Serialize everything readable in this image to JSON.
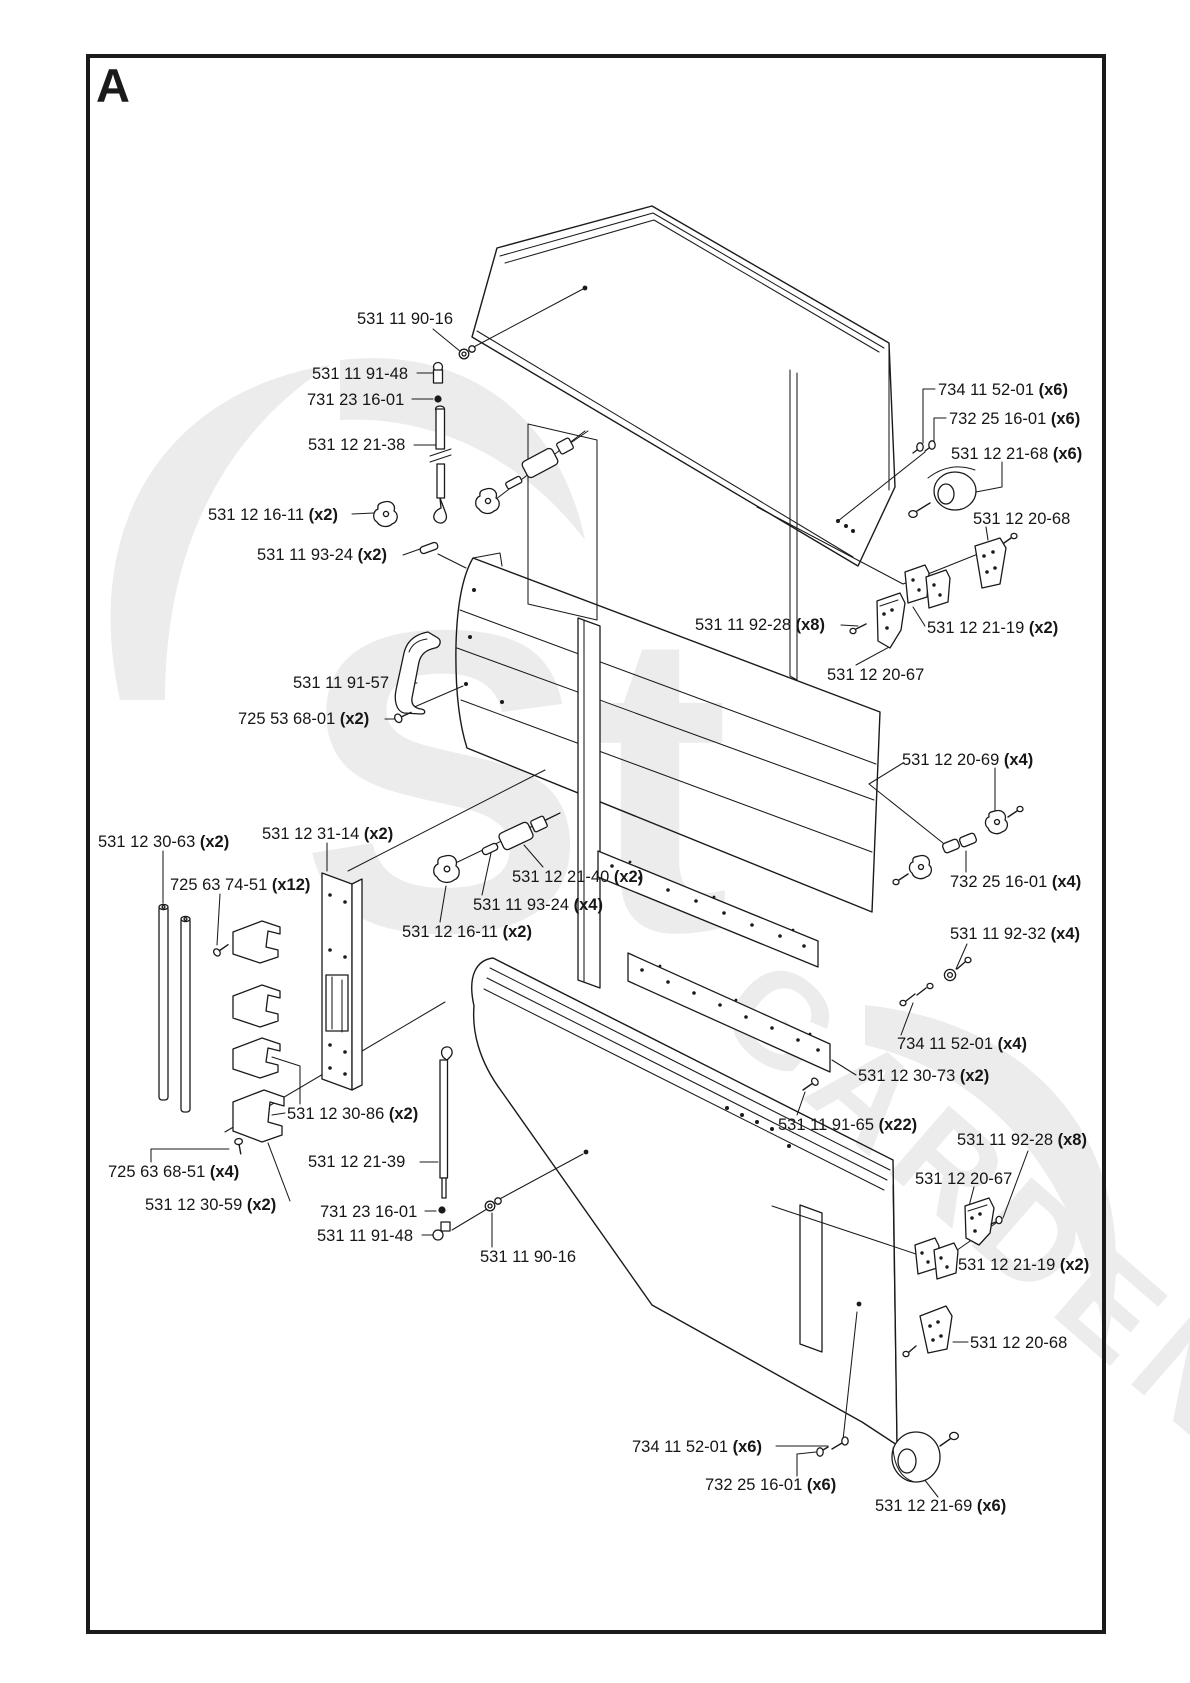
{
  "page": {
    "figure_label": "A"
  },
  "watermark": {
    "text": "GARDEN",
    "text2": "St",
    "color": "#ececec"
  },
  "colors": {
    "line": "#1a1a1a",
    "background": "#ffffff"
  },
  "labels": [
    {
      "text": "531 11 90-16",
      "qty": ""
    },
    {
      "text": "531 11 91-48",
      "qty": ""
    },
    {
      "text": "731 23 16-01",
      "qty": ""
    },
    {
      "text": "531 12 21-38",
      "qty": ""
    },
    {
      "text": "531 12 16-11",
      "qty": " (x2)"
    },
    {
      "text": "531 11 93-24",
      "qty": " (x2)"
    },
    {
      "text": "734 11 52-01",
      "qty": " (x6)"
    },
    {
      "text": "732 25 16-01",
      "qty": " (x6)"
    },
    {
      "text": "531 12 21-68",
      "qty": " (x6)"
    },
    {
      "text": "531 12 20-68",
      "qty": ""
    },
    {
      "text": "531 11 92-28",
      "qty": " (x8)"
    },
    {
      "text": "531 12 21-19",
      "qty": " (x2)"
    },
    {
      "text": "531 12 20-67",
      "qty": ""
    },
    {
      "text": "531 11 91-57",
      "qty": ""
    },
    {
      "text": "725 53 68-01",
      "qty": " (x2)"
    },
    {
      "text": "531 12 20-69",
      "qty": " (x4)"
    },
    {
      "text": "531 12 30-63",
      "qty": " (x2)"
    },
    {
      "text": "531 12 31-14",
      "qty": " (x2)"
    },
    {
      "text": "725 63 74-51",
      "qty": " (x12)"
    },
    {
      "text": "531 12 21-40",
      "qty": " (x2)"
    },
    {
      "text": "531 11 93-24",
      "qty": " (x4)"
    },
    {
      "text": "531 12 16-11",
      "qty": " (x2)"
    },
    {
      "text": "732 25 16-01",
      "qty": " (x4)"
    },
    {
      "text": "531 11 92-32",
      "qty": " (x4)"
    },
    {
      "text": "734 11 52-01",
      "qty": " (x4)"
    },
    {
      "text": "531 12 30-73",
      "qty": " (x2)"
    },
    {
      "text": "531 11 91-65",
      "qty": " (x22)"
    },
    {
      "text": "531 11 92-28",
      "qty": " (x8)"
    },
    {
      "text": "531 12 20-67",
      "qty": ""
    },
    {
      "text": "531 12 30-86",
      "qty": " (x2)"
    },
    {
      "text": "531 12 21-39",
      "qty": ""
    },
    {
      "text": "725 63 68-51",
      "qty": " (x4)"
    },
    {
      "text": "531 12 30-59",
      "qty": " (x2)"
    },
    {
      "text": "731 23 16-01",
      "qty": ""
    },
    {
      "text": "531 11 91-48",
      "qty": ""
    },
    {
      "text": "531 11 90-16",
      "qty": ""
    },
    {
      "text": "531 12 21-19",
      "qty": " (x2)"
    },
    {
      "text": "531 12 20-68",
      "qty": ""
    },
    {
      "text": "734 11 52-01",
      "qty": " (x6)"
    },
    {
      "text": "732 25 16-01",
      "qty": " (x6)"
    },
    {
      "text": "531 12 21-69",
      "qty": " (x6)"
    }
  ]
}
